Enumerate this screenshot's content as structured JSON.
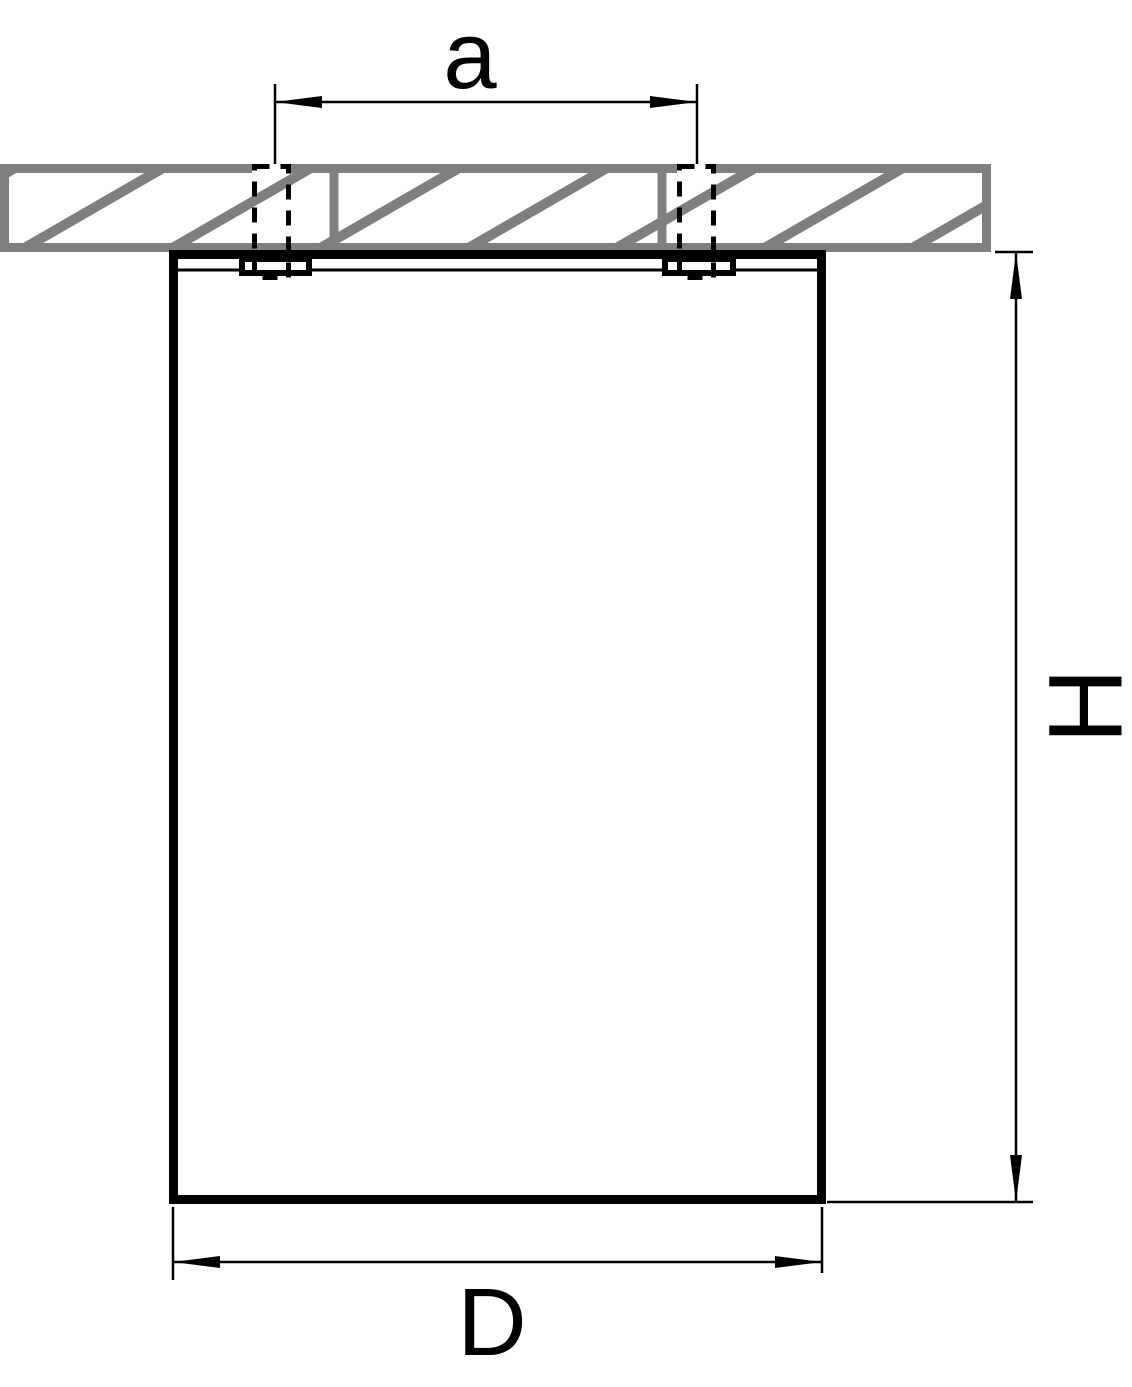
{
  "diagram": {
    "type": "technical-dimension-drawing",
    "subject": "surface-mounted-ceiling-fixture-side-view",
    "labels": {
      "hole_spacing": "a",
      "height": "H",
      "diameter": "D"
    },
    "colors": {
      "line": "#000000",
      "ceiling_hatch": "#7f7f7f",
      "background": "#ffffff"
    }
  }
}
